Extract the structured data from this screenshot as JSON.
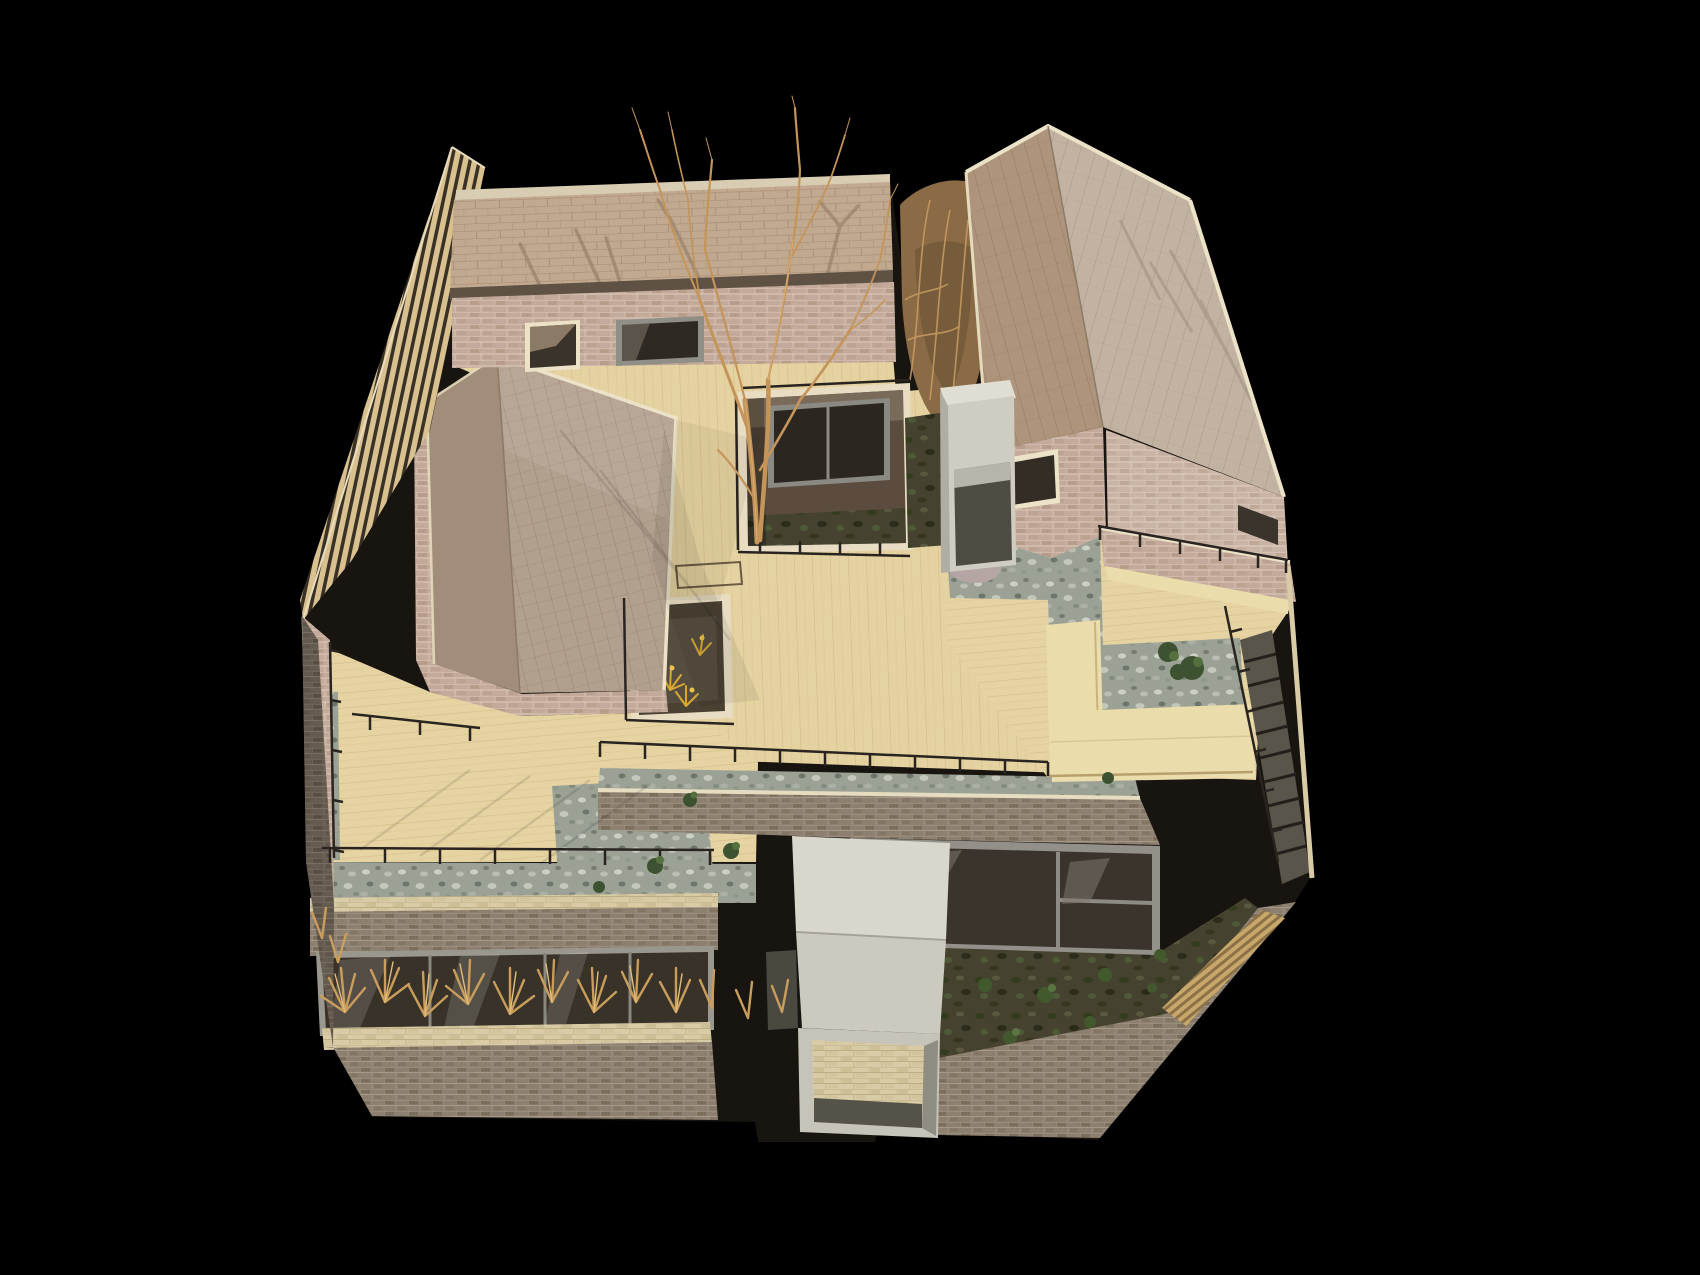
{
  "meta": {
    "title": "Architectural scale model photograph",
    "alt": "Aerial photograph of a physical architectural scale model on a black background: three gabled brick houses with tiled roofs arranged around a central timber deck courtyard with a bare tree, sunken light wells, gravel beds with small green shrubs, thin black metal railings, concrete entrance volumes, dried grasses along the lower facade planter, and an external stair at the right edge."
  },
  "scene": {
    "background": "black studio backdrop",
    "objects": [
      "gabled-house-top-left",
      "gabled-house-top-right",
      "gabled-house-left",
      "timber-deck-courtyard",
      "bare-courtyard-tree",
      "sunken-central-lightwell",
      "small-lightwell-with-yellow-plants",
      "lower-terrace",
      "front-facade-with-window-band",
      "dried-grass-planter",
      "concrete-entrance-canopy",
      "concrete-entry-box",
      "sunken-moss-garden",
      "gravel-beds-with-shrubs",
      "l-shaped-timber-bench",
      "black-metal-railings",
      "timber-slat-screen",
      "external-stair",
      "timber-fence-on-wall",
      "dried-climbing-vines"
    ]
  },
  "palette": {
    "c-bg": "#000000",
    "c-deck": "#e5d2a1",
    "c-deck-line": "#cdb47e",
    "c-bench": "#eadcab",
    "c-brick-pink": "#c3aa9a",
    "c-brick-pink-mortar": "#dac8b9",
    "c-brick-grey": "#8d8071",
    "c-brick-grey-mortar": "#a69887",
    "c-brick-cream": "#d8cba6",
    "c-trim": "#ece2c8",
    "c-shingle": "#c1a98f",
    "c-roof-left": "#b2a08e",
    "c-roof-b-dark": "#ad947b",
    "c-roof-b-light": "#c2b2a1",
    "c-gravel": "#9ba295",
    "c-moss": "#45422f",
    "c-concrete": "#d2cfc4",
    "c-glass": "#35302b",
    "c-frame": "#8f8f88",
    "c-railing": "#292420",
    "c-branch": "#c49459",
    "c-grass": "#c99e5c",
    "c-shrub": "#3d5230",
    "c-flower": "#d8a832",
    "c-rock": "#b5a6a4"
  }
}
